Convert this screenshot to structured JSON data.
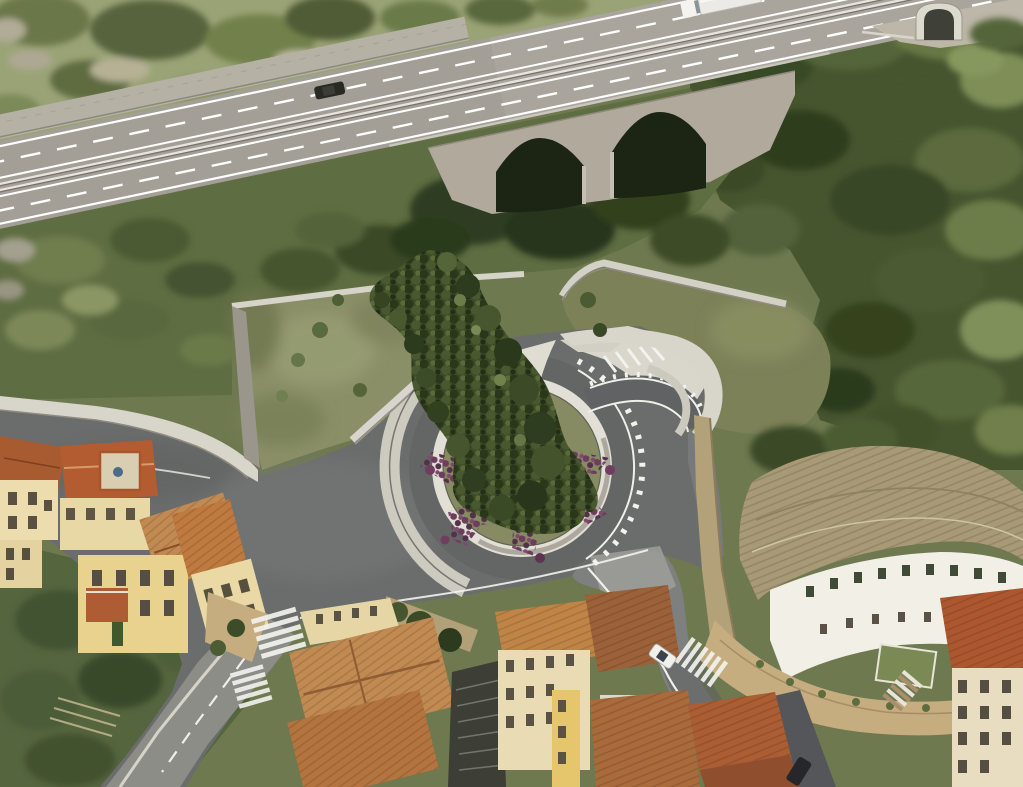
{
  "meta": {
    "title": "Aerial photomontage of a proposed roundabout and green-roof park beside an elevated highway in a Mediterranean hill town",
    "kind": "aerial-render-photomontage"
  },
  "palette": {
    "vegBase": "#6e7950",
    "hillGrass": "#9aa376",
    "forest": "#47552f",
    "scrub": "#5f6d42",
    "oliveDeck": "#7c8158",
    "highwayAsphalt": "#a49f96",
    "stoneWall": "#b6b1a5",
    "bridgeStone": "#b1aa9c",
    "archDark": "#1c2414",
    "concrete": "#d8d5cb",
    "concreteShadow": "#9a968b",
    "newAsphalt": "#6b6d6c",
    "oldAsphalt": "#8d8d88",
    "lawn": "#8a8f68",
    "islandLawn": "#868b64",
    "flowerPurple": "#6f3d5d",
    "treeDark": "#2e3c21",
    "roofTan": "#c18a52",
    "roofRed": "#a85a30",
    "roofOrange": "#bd6f3c",
    "curvedRoof": "#a89a77",
    "facadeCream": "#ecdcae",
    "facadeYellow": "#e9d28e",
    "facadeWhite": "#f2efe6",
    "terraceTan": "#c6ad80",
    "markingWhite": "#f2f2ee",
    "carDark": "#2a2a25",
    "truckWhite": "#eceae6",
    "carWhite": "#f0f0ec"
  },
  "scene": {
    "highway": {
      "label": "elevated dual-carriageway highway crossing top of image",
      "features": [
        "dashed lane lines",
        "central guardrail",
        "stone retaining wall",
        "tunnel portal at top right"
      ],
      "vehicles": [
        {
          "label": "white truck with trailer",
          "position": "top right"
        },
        {
          "label": "dark car",
          "position": "upper left carriageway"
        }
      ]
    },
    "viaduct": {
      "label": "stone viaduct with two masonry arches",
      "arches": 2
    },
    "project_render": {
      "roundabout": {
        "label": "new roundabout with planted central island"
      },
      "island_planting": {
        "flowers": "purple groundcover in branching star pattern",
        "trees": "dark evergreen tree band cascading from hillside into island"
      },
      "green_roof": {
        "label": "olive-green lawn deck behind white concrete retaining walls"
      },
      "olive_deck": {
        "label": "flat olive green deck at upper right of junction"
      },
      "walls": {
        "label": "curved white concrete retaining walls"
      },
      "north_east_arm": {
        "label": "new road arm with white edge ticks and chevron markings"
      }
    },
    "town": {
      "left_cluster": {
        "label": "old town houses, terracotta roofs, cream and yellow facades, gardens"
      },
      "center_cluster": {
        "label": "dense housing block with stepped alley between roofs"
      },
      "right_complex": {
        "label": "large curved terraced building with long tiled roof, white facade, green shutters, terraces and stairs"
      }
    },
    "roads": {
      "southwest_road": {
        "label": "existing road to lower-left",
        "crosswalks": 2,
        "center_line": "dashed"
      },
      "southeast_road": {
        "label": "road descending along stone retaining wall",
        "crosswalks": 1
      },
      "vehicles": [
        {
          "label": "white car parked near crosswalk",
          "position": "center right"
        },
        {
          "label": "dark parked car",
          "position": "bottom right"
        }
      ]
    }
  }
}
